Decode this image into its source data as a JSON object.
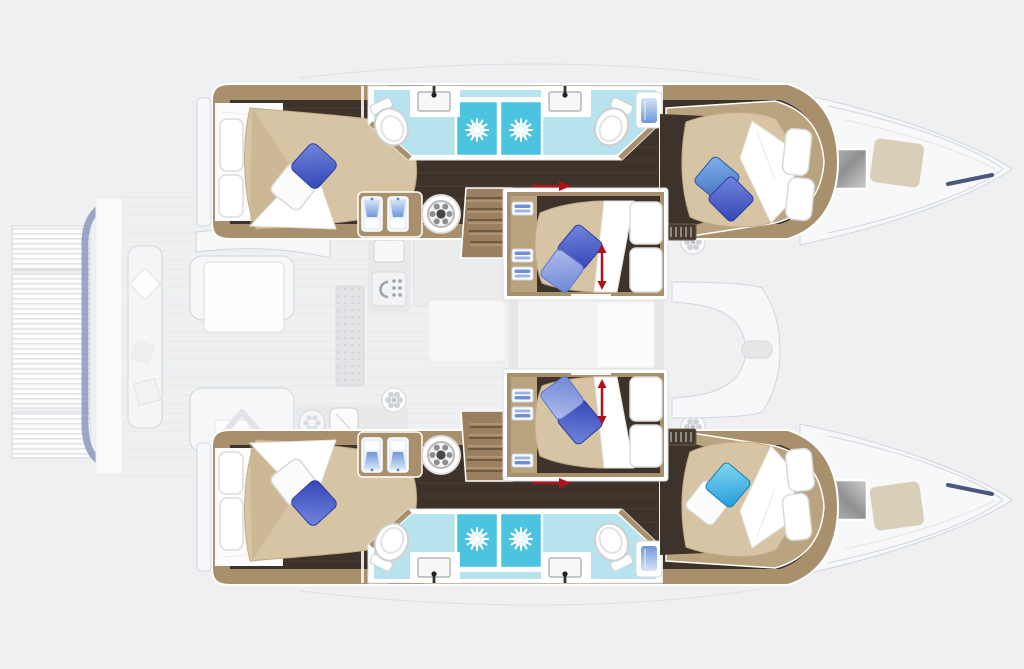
{
  "palette": {
    "bg": "#eff0f1",
    "ghost-fill": "#f7f8f9",
    "ghost-line": "#d3d6da",
    "ghost-block": "#e8e9eb",
    "hull-wood": "#a8906d",
    "hull-wood-light": "#baa37f",
    "hull-wood-dark": "#6e5a45",
    "hull-floor": "#3e332a",
    "floor-line": "#5c4d3e",
    "step-wood": "#9a8060",
    "step-line": "#6d593f",
    "bed-beige": "#d6c4a5",
    "bed-beige-dark": "#c2ab85",
    "bath-floor": "#b7e3ee",
    "shower-blue": "#4cc4df",
    "red-accent": "#b2111c",
    "navy": "#2e3c68",
    "navy-soft": "#8d98bb",
    "panel-beige": "#d9ceb8",
    "pillow-royal-dark": "#2c3f9e"
  },
  "scene": {
    "description": "Top-down interior deck plan of a sailing catamaran with two hulls, two center cabins, twin shower rooms and ghosted deck furniture",
    "vessel_type": "sailing catamaran",
    "double_berths_visible": 6,
    "bathrooms": [
      {
        "position": "upper hull",
        "showers": 2,
        "sinks": 2,
        "toilets": 2,
        "floor_color": "#b7e3ee"
      },
      {
        "position": "lower hull",
        "showers": 2,
        "sinks": 2,
        "toilets": 2,
        "floor_color": "#b7e3ee"
      }
    ],
    "pillows": {
      "upper_aft_cabin": [
        "royal-blue",
        "white"
      ],
      "upper_forward_cabin": [
        "mid-blue",
        "royal-blue"
      ],
      "lower_aft_cabin": [
        "white",
        "royal-blue"
      ],
      "lower_forward_cabin": [
        "sky-blue",
        "white"
      ],
      "center_cabins": [
        "royal-blue",
        "periwinkle"
      ]
    },
    "red_arrows": "berth extension and sliding-door direction markers",
    "labels": {
      "plan": "Catamaran deck plan, top view",
      "top_hull": "Upper hull: aft cabin, shower room, forward cabin",
      "bottom_hull": "Lower hull: aft cabin, shower room, forward cabin",
      "nacelle_top": "Center double cabin (upper)",
      "nacelle_bottom": "Center double cabin (lower)",
      "salon": "Ghosted salon and galley deck furniture",
      "aft_deck": "Ghosted aft cockpit and transom platforms",
      "fore_deck": "Ghosted forward cockpit seating",
      "bow": "Bow deck with hatch and sunpad"
    }
  }
}
